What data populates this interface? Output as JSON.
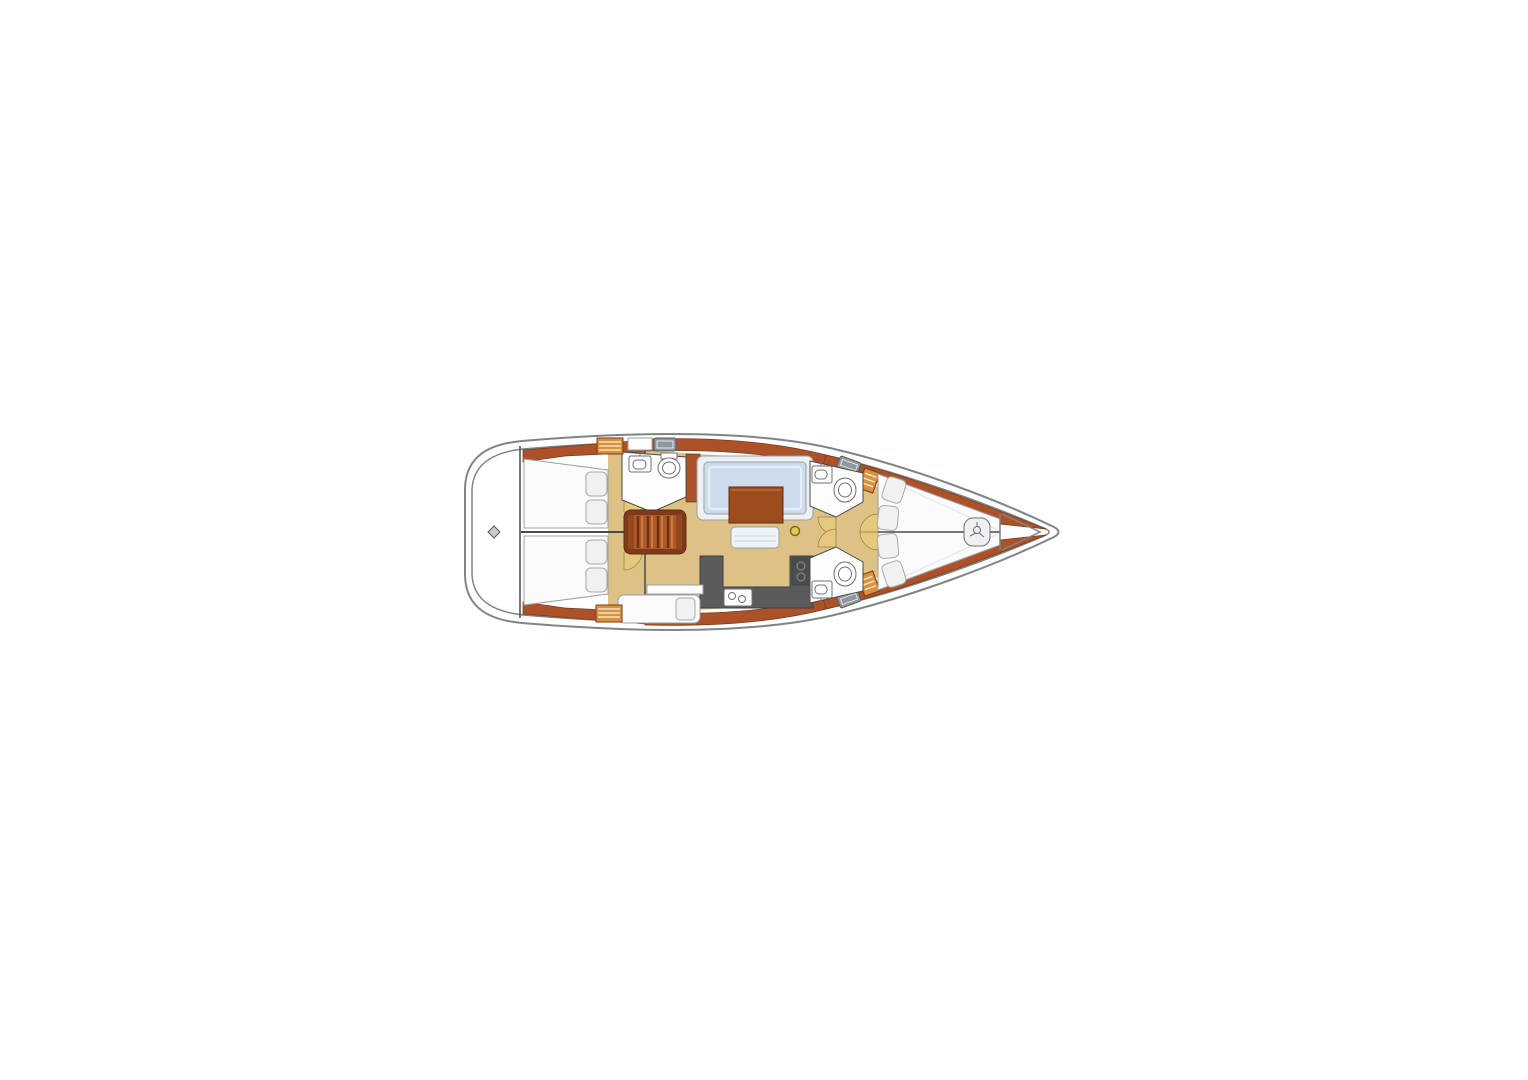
{
  "diagram": {
    "type": "yacht-interior-floorplan",
    "orientation": "bow-right",
    "areas": [
      "swim-platform",
      "aft-cabin-port",
      "aft-cabin-starboard",
      "companionway-steps",
      "aft-head",
      "salon-settee",
      "salon-table",
      "galley",
      "nav-seat",
      "forward-head-port",
      "forward-head-starboard",
      "forward-cabin",
      "anchor-locker"
    ],
    "icons": [
      "sink-icon",
      "toilet-icon",
      "stove-burners-icon",
      "deck-hatch-icon",
      "mast-post-icon",
      "windlass-icon",
      "transom-fitting-icon"
    ]
  },
  "palette": {
    "background": "#ffffff",
    "hull_fill": "#ffffff",
    "hull_stroke": "#7f8486",
    "line_dark": "#4a4a4a",
    "wood": "#ad5129",
    "wood_dark": "#7b3a1b",
    "wood_light": "#c87a43",
    "locker_orange": "#d9913f",
    "locker_stripe": "#f3e4c2",
    "floor_tan": "#dec285",
    "room_white": "#fdfdfd",
    "room_stroke": "#4a4a4a",
    "bed_white": "#fbfbfb",
    "bed_stroke": "#9aa0a4",
    "pillow_fill": "#f1f1f1",
    "pillow_stroke": "#a8a8a8",
    "settee_fill": "#eef1f3",
    "settee_stroke": "#9a9fa3",
    "settee_blue": "#cddded",
    "bench_fill": "#eef3f7",
    "bench_blue": "#c5d6e2",
    "table_brown": "#9d4c1e",
    "table_stroke": "#5f2c10",
    "counter_gray": "#595b5d",
    "counter_stroke": "#3e3f41",
    "stove_gray": "#4a4c4e",
    "burner_ring": "#8e9092",
    "hatch_gray": "#8f989e",
    "hatch_stroke": "#555a5c",
    "door_tan": "#e6c77e",
    "door_stroke": "#9b8148",
    "mast_yellow": "#e8c64f",
    "mast_stroke": "#7a6a28",
    "fitting_gray": "#c9ccce",
    "steps_base": "#7e3b1b",
    "steps_mid": "#b05a28",
    "steps_dark": "#6e3113",
    "steps_light": "#cd7a42",
    "steps_cap": "#94481f",
    "fixture_stroke": "#6d7173",
    "white": "#ffffff"
  }
}
